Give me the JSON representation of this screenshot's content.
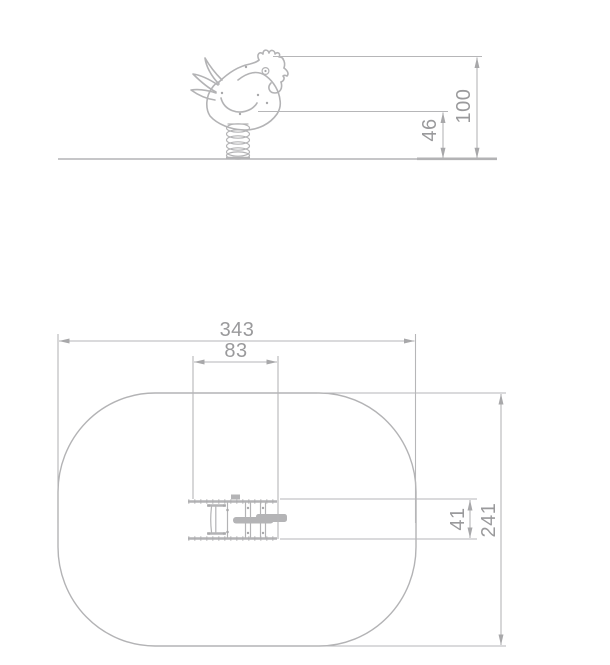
{
  "side_view": {
    "total_height": "100",
    "seat_height": "46"
  },
  "plan_view": {
    "zone_length": "343",
    "unit_length": "83",
    "unit_width": "41",
    "zone_width": "241"
  },
  "colors": {
    "line_color": "#b3b3b5",
    "dim_color": "#b6b6b8",
    "arrow_color": "#a8a8aa",
    "bar_color": "#b4b4b6",
    "text_color": "#9a9a9c",
    "bg_color": "#ffffff"
  }
}
